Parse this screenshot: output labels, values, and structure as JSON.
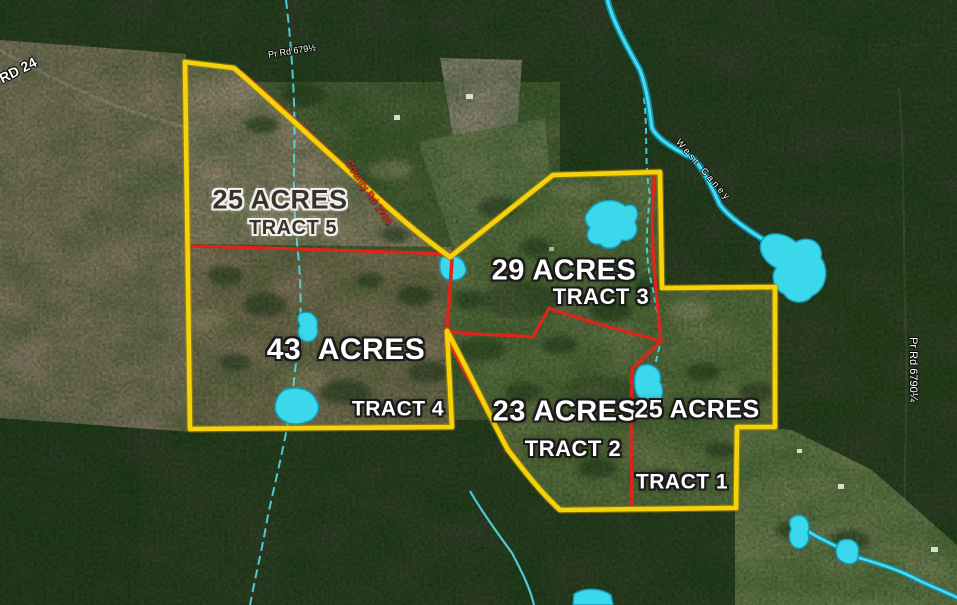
{
  "map": {
    "tracts": {
      "tract5": {
        "acres": "25 ACRES",
        "label": "TRACT 5"
      },
      "tract3": {
        "acres": "29 ACRES",
        "label": "TRACT 3"
      },
      "tract4": {
        "acres": "43  ACRES",
        "label": "TRACT 4"
      },
      "tract2": {
        "acres": "23 ACRES",
        "label": "TRACT 2"
      },
      "tract1": {
        "acres": "25 ACRES",
        "label": "TRACT 1"
      }
    },
    "roads": {
      "rd24": "RD 24",
      "pr_rd_679": "Pr Rd 679½",
      "county_rd_2780": "County Rd 2780",
      "pr_rd_6790": "Pr Rd 6790¼"
    },
    "water": {
      "creek_label": "West Caney"
    },
    "colors": {
      "boundary_yellow": "#f4d30b",
      "boundary_red": "#e0241b",
      "water_cyan": "#3fd9ec"
    }
  }
}
